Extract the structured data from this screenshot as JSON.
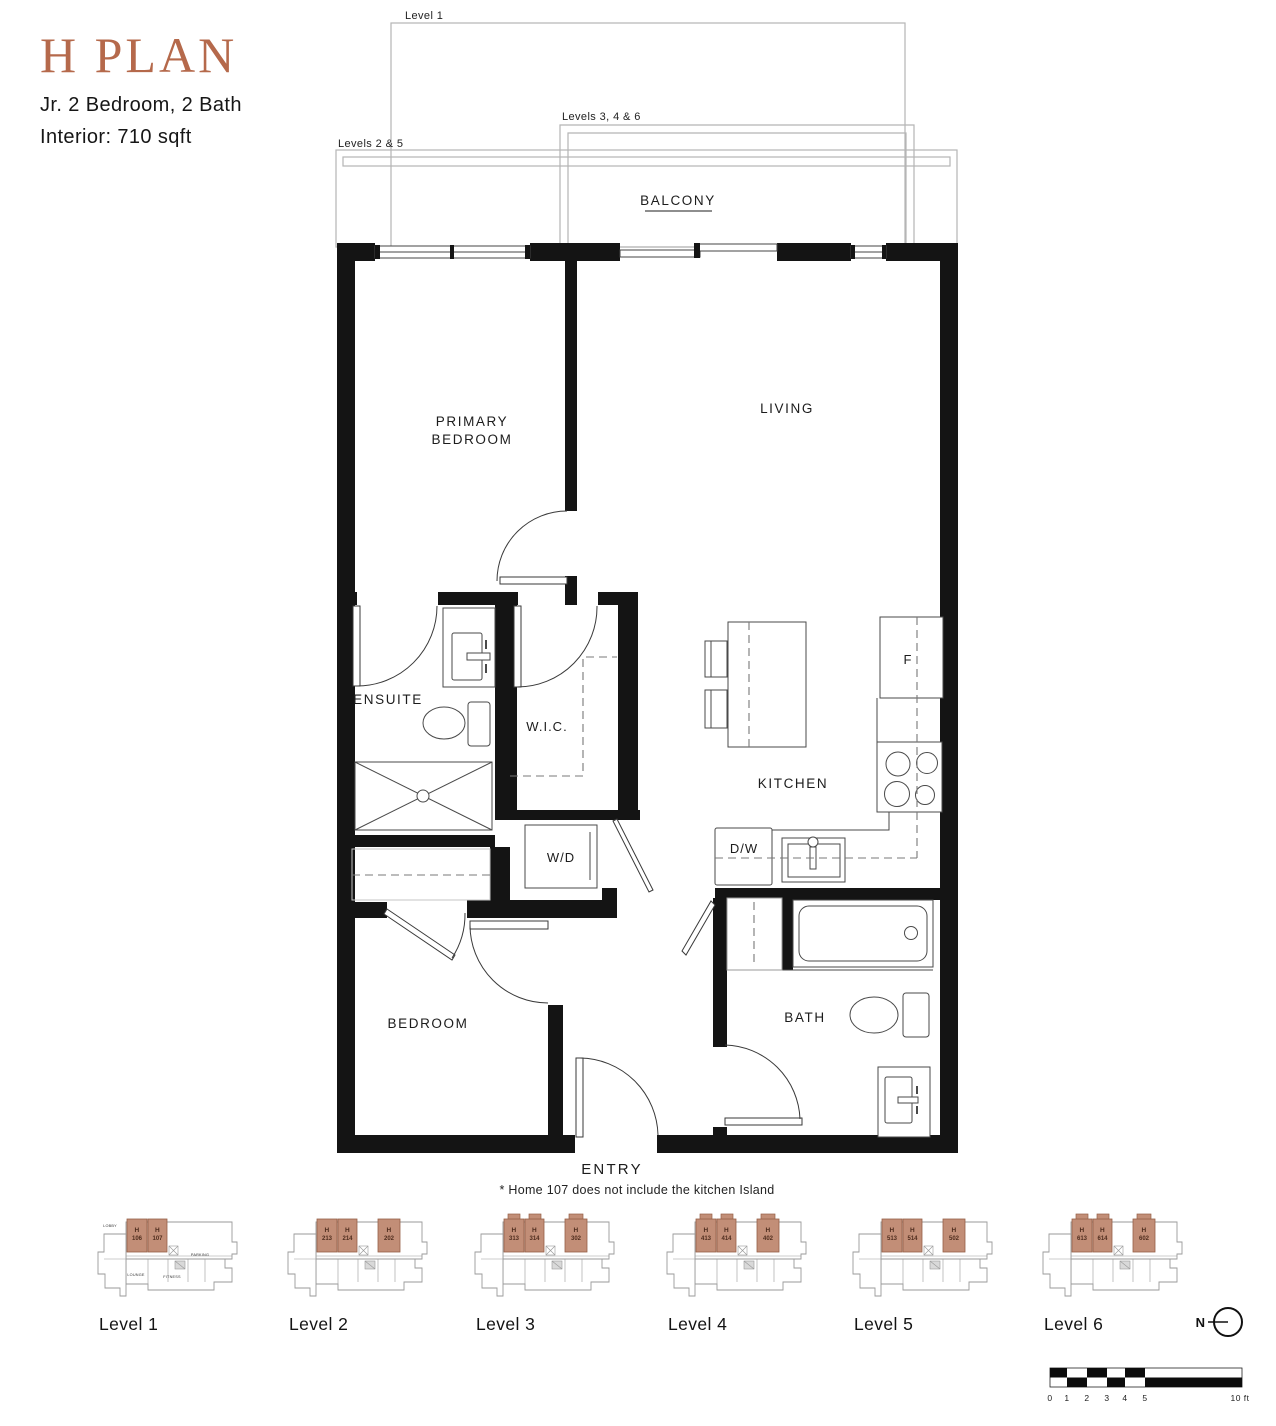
{
  "header": {
    "title": "H PLAN",
    "subtitle": "Jr. 2 Bedroom, 2 Bath",
    "interior": "Interior: 710 sqft"
  },
  "plan": {
    "balcony_labels": {
      "level1": "Level 1",
      "levels346": "Levels 3, 4 & 6",
      "levels25": "Levels 2 & 5"
    },
    "rooms": {
      "balcony": "BALCONY",
      "primary_line1": "PRIMARY",
      "primary_line2": "BEDROOM",
      "living": "LIVING",
      "ensuite": "ENSUITE",
      "wic": "W.I.C.",
      "wd": "W/D",
      "kitchen": "KITCHEN",
      "dw": "D/W",
      "fridge": "F",
      "bath": "BATH",
      "bedroom": "BEDROOM",
      "entry": "ENTRY"
    },
    "footnote": "* Home 107 does not include the kitchen Island"
  },
  "levels": [
    {
      "name": "Level 1",
      "tabs": false,
      "units": [
        {
          "l1": "H",
          "l2": "106"
        },
        {
          "l1": "H",
          "l2": "107"
        }
      ],
      "amenities": [
        {
          "t": "LOBBY",
          "x": 20,
          "y": 15
        },
        {
          "t": "PARKING",
          "x": 110,
          "y": 44
        },
        {
          "t": "LOUNGE",
          "x": 46,
          "y": 64
        },
        {
          "t": "FITNESS",
          "x": 82,
          "y": 66
        }
      ]
    },
    {
      "name": "Level 2",
      "tabs": false,
      "units": [
        {
          "l1": "H",
          "l2": "213"
        },
        {
          "l1": "H",
          "l2": "214"
        },
        {
          "l1": "H",
          "l2": "202"
        }
      ],
      "amenities": []
    },
    {
      "name": "Level 3",
      "tabs": true,
      "units": [
        {
          "l1": "H",
          "l2": "313"
        },
        {
          "l1": "H",
          "l2": "314"
        },
        {
          "l1": "H",
          "l2": "302"
        }
      ],
      "amenities": []
    },
    {
      "name": "Level 4",
      "tabs": true,
      "units": [
        {
          "l1": "H",
          "l2": "413"
        },
        {
          "l1": "H",
          "l2": "414"
        },
        {
          "l1": "H",
          "l2": "402"
        }
      ],
      "amenities": []
    },
    {
      "name": "Level 5",
      "tabs": false,
      "units": [
        {
          "l1": "H",
          "l2": "513"
        },
        {
          "l1": "H",
          "l2": "514"
        },
        {
          "l1": "H",
          "l2": "502"
        }
      ],
      "amenities": []
    },
    {
      "name": "Level 6",
      "tabs": true,
      "units": [
        {
          "l1": "H",
          "l2": "613"
        },
        {
          "l1": "H",
          "l2": "614"
        },
        {
          "l1": "H",
          "l2": "602"
        }
      ],
      "amenities": []
    }
  ],
  "compass": {
    "label": "N"
  },
  "scalebar": {
    "ticks": [
      "0",
      "1",
      "2",
      "3",
      "4",
      "5"
    ],
    "end": "10 ft"
  },
  "colors": {
    "accent": "#b5694b",
    "wall": "#141414",
    "keyplan_outline": "#9a9a9a",
    "unit_fill": "#c28e77",
    "unit_stroke": "#966047",
    "unit_text": "#4f2d1e"
  }
}
